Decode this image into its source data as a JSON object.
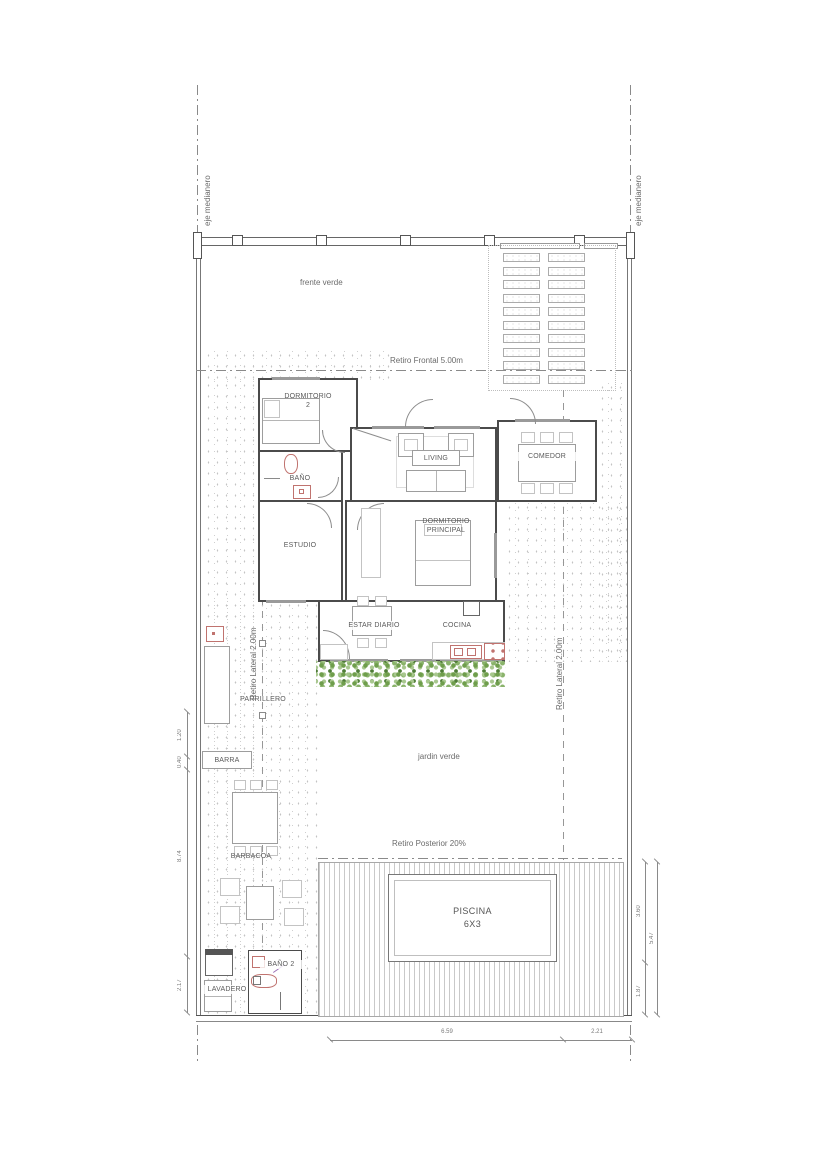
{
  "plan": {
    "boundary": {
      "eje_left": "eje medianero",
      "eje_right": "eje medianero"
    },
    "zones": {
      "frente_verde": "frente verde",
      "retiro_frontal": "Retiro Frontal 5.00m",
      "retiro_lateral_left": "Retiro Lateral 2.00m",
      "retiro_lateral_right": "Retiro Lateral 2.00m",
      "retiro_posterior": "Retiro Posterior 20%",
      "jardin_verde": "jardin verde"
    },
    "rooms": {
      "dormitorio2": "DORMITORIO\n2",
      "bano": "BAÑO",
      "estudio": "ESTUDIO",
      "living": "LIVING",
      "comedor": "COMEDOR",
      "dormitorio_principal": "DORMITORIO\nPRINCIPAL",
      "estar_diario": "ESTAR DIARIO",
      "cocina": "COCINA",
      "parrillero": "PARRILLERO",
      "barra": "BARRA",
      "barbacoa": "BARBACOA",
      "bano2": "BAÑO 2",
      "lavadero": "LAVADERO",
      "piscina": "PISCINA\n6X3"
    },
    "dimensions": {
      "left": [
        "1.20",
        "0.40",
        "8.74",
        "2.17"
      ],
      "right": [
        "3.60",
        "5.47",
        "1.87"
      ],
      "bottom": [
        "6.59",
        "2.21"
      ]
    },
    "colors": {
      "wall": "#4b4b4b",
      "fixture_red": "#c0736f",
      "hedge_green": "#6f9e4c",
      "stipple_gray": "#c3c3c3",
      "text": "#5a5a5a"
    }
  }
}
